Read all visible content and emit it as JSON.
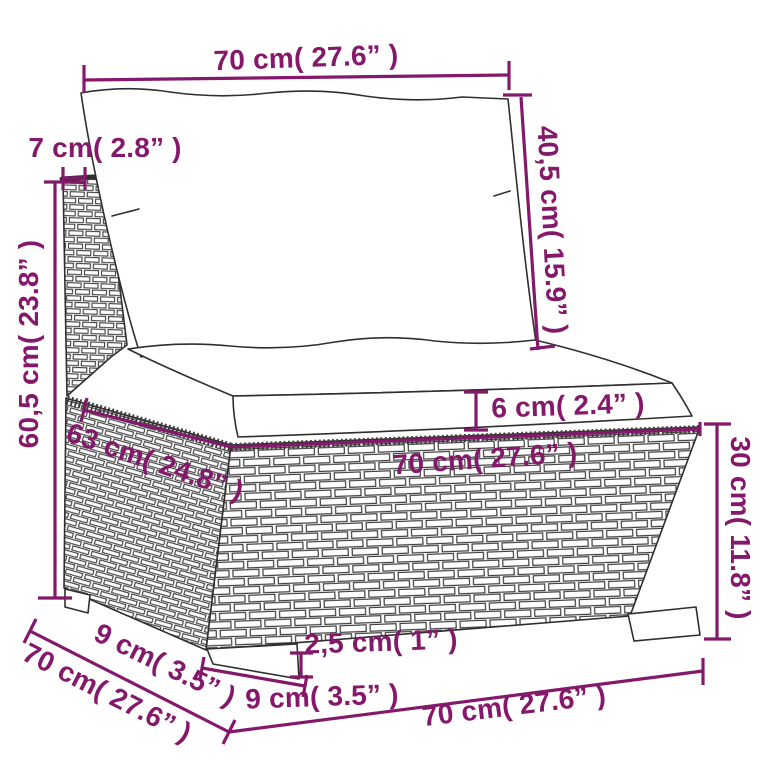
{
  "diagram": {
    "description": "furniture dimension sketch of a rattan middle sofa section with cushions",
    "colors": {
      "dimension": "#84196b",
      "sketch_line": "#2f2f2f",
      "background": "#ffffff"
    },
    "dims": {
      "back_width": {
        "label": "70 cm( 27.6” )"
      },
      "back_thickness": {
        "label": "7 cm( 2.8” )"
      },
      "back_cushion_height": {
        "label": "40,5 cm( 15.9” )"
      },
      "total_height": {
        "label": "60,5 cm( 23.8” )"
      },
      "seat_cushion_thickness": {
        "label": "6 cm( 2.4” )"
      },
      "seat_depth": {
        "label": "63 cm( 24.8” )"
      },
      "seat_width": {
        "label": "70 cm( 27.6” )"
      },
      "base_height": {
        "label": "30 cm( 11.8” )"
      },
      "foot_height": {
        "label": "2,5 cm( 1” )"
      },
      "foot_width": {
        "label": "9 cm( 3.5” )"
      },
      "foot_depth": {
        "label": "9 cm( 3.5” )"
      },
      "base_depth": {
        "label": "70 cm( 27.6” )"
      },
      "base_width_bottom": {
        "label": "70 cm( 27.6” )"
      }
    }
  }
}
